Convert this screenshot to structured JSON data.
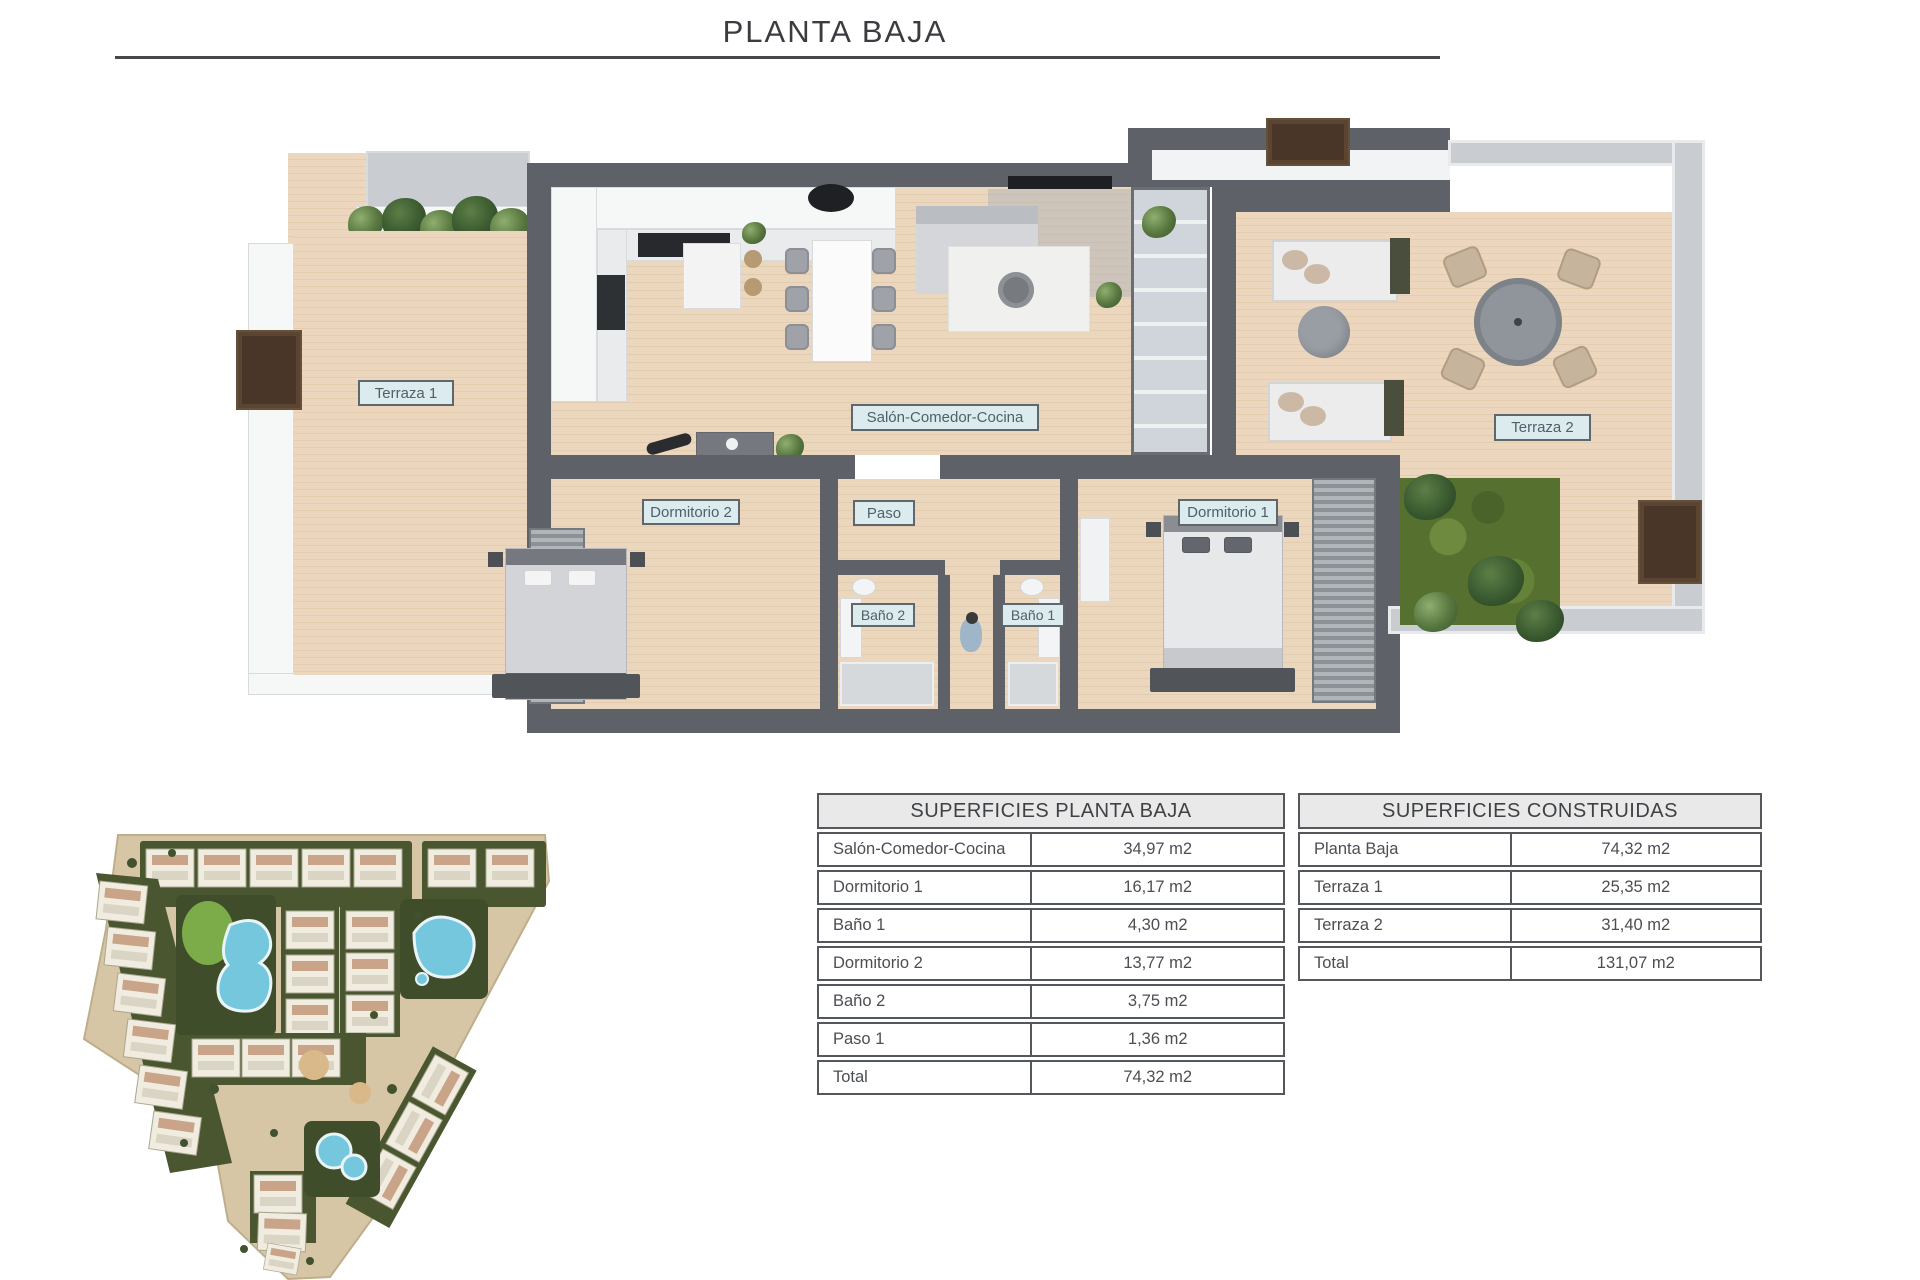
{
  "title": "PLANTA BAJA",
  "fp": {
    "labels": {
      "t1": "Terraza 1",
      "salon": "Salón-Comedor-Cocina",
      "d2": "Dormitorio 2",
      "paso": "Paso",
      "d1": "Dormitorio 1",
      "b2": "Baño 2",
      "b1": "Baño 1",
      "t2": "Terraza 2"
    }
  },
  "tables": {
    "pb": {
      "title": "SUPERFICIES PLANTA BAJA",
      "rows": [
        {
          "label": "Salón-Comedor-Cocina",
          "value": "34,97 m2"
        },
        {
          "label": "Dormitorio 1",
          "value": "16,17 m2"
        },
        {
          "label": "Baño 1",
          "value": "4,30 m2"
        },
        {
          "label": "Dormitorio 2",
          "value": "13,77 m2"
        },
        {
          "label": "Baño 2",
          "value": "3,75 m2"
        },
        {
          "label": "Paso 1",
          "value": "1,36 m2"
        },
        {
          "label": "Total",
          "value": "74,32 m2"
        }
      ]
    },
    "con": {
      "title": "SUPERFICIES CONSTRUIDAS",
      "rows": [
        {
          "label": "Planta Baja",
          "value": "74,32 m2"
        },
        {
          "label": "Terraza 1",
          "value": "25,35 m2"
        },
        {
          "label": "Terraza 2",
          "value": "31,40 m2"
        },
        {
          "label": "Total",
          "value": "131,07 m2"
        }
      ]
    }
  },
  "colors": {
    "wall": "#5e6268",
    "wood": "#e7d3ba",
    "label_bg": "#dcebed",
    "pool": "#74c7dc",
    "landscape_green": "#49562f",
    "table_border": "#54575b"
  }
}
